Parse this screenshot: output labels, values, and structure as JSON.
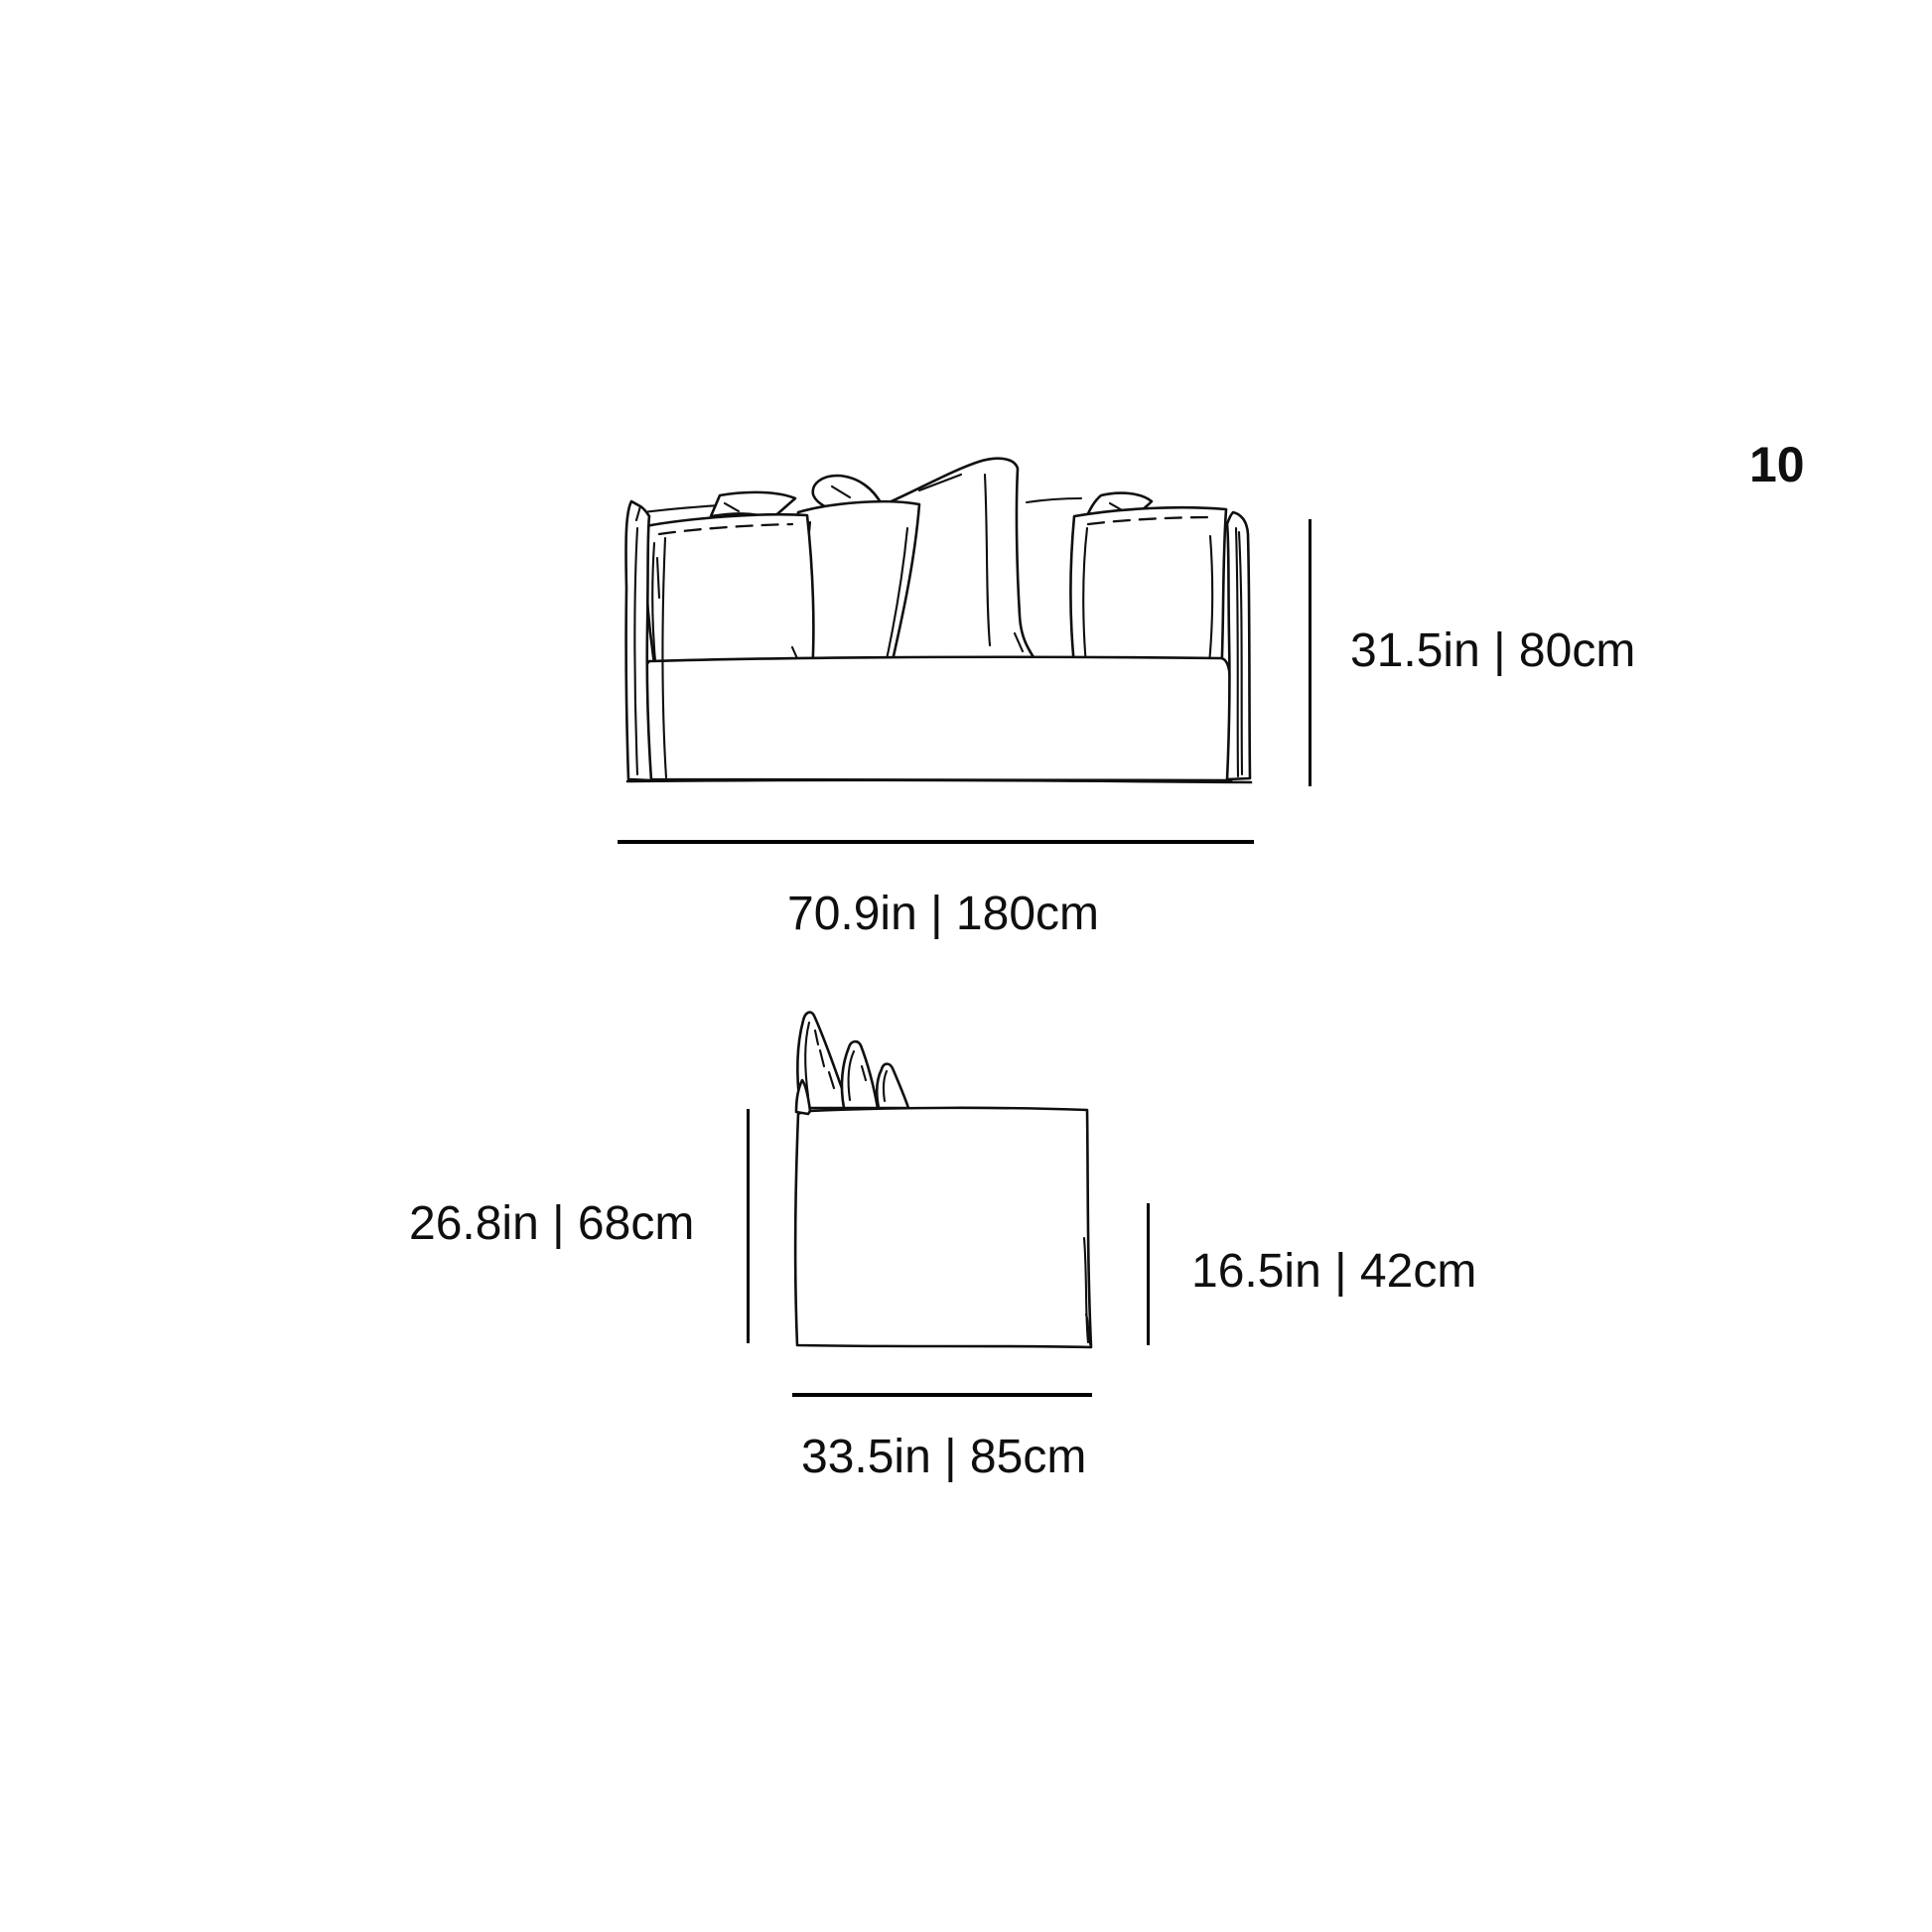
{
  "page": {
    "number": "10"
  },
  "front_view": {
    "title": "sofa front elevation drawing",
    "height_label": "31.5in | 80cm",
    "width_label": "70.9in | 180cm"
  },
  "side_view": {
    "title": "sofa side elevation drawing",
    "back_height_label": "26.8in | 68cm",
    "seat_height_label": "16.5in | 42cm",
    "depth_label": "33.5in | 85cm"
  },
  "colors": {
    "ink": "#0f0f0f",
    "dimension_line": "#000000",
    "background": "#ffffff"
  }
}
